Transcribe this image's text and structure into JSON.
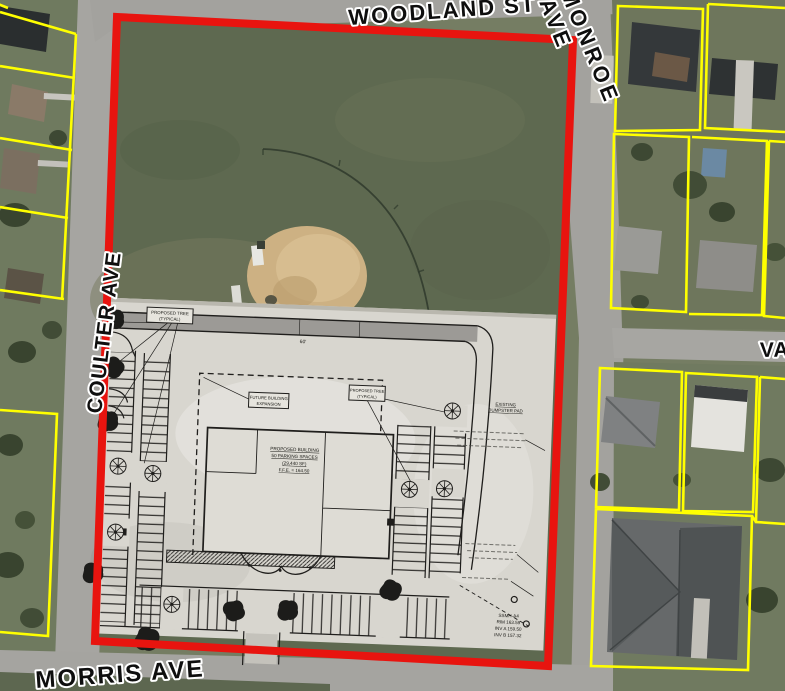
{
  "streets": {
    "woodland": "WOODLAND ST",
    "monroe_word1": "MONROE",
    "monroe_word2": "AVE",
    "coulter": "COULTER AVE",
    "morris": "MORRIS AVE",
    "va": "VA"
  },
  "colors": {
    "boundary": "#e8140f",
    "parcel_line": "#ffff00",
    "field_green": "#5e6950",
    "infield_dirt": "#cdb183",
    "road_gray": "#a3a29e",
    "plan_paper": "#d8d6cf",
    "plan_ink": "#1f1e1c"
  },
  "site_plan": {
    "labels": {
      "tree_l1": "PROPOSED TREE",
      "tree_l2": "(TYPICAL)",
      "exp_l1": "FUTURE BUILDING",
      "exp_l2": "EXPANSION",
      "dump_l1": "EXISTING",
      "dump_l2": "DUMPSTER PAD",
      "bldg_l1": "PROPOSED BUILDING",
      "bldg_l2": "50 PARKING SPACES",
      "bldg_l3": "(29,440 SF)",
      "bldg_l4": "F.F.E. = 164.50"
    },
    "dimensions": {
      "drive_width": "60'"
    },
    "notes": {
      "manhole": [
        "SSMH-A4",
        "RIM 163.59",
        "INV A 159.50",
        "INV B 157.32"
      ]
    }
  }
}
